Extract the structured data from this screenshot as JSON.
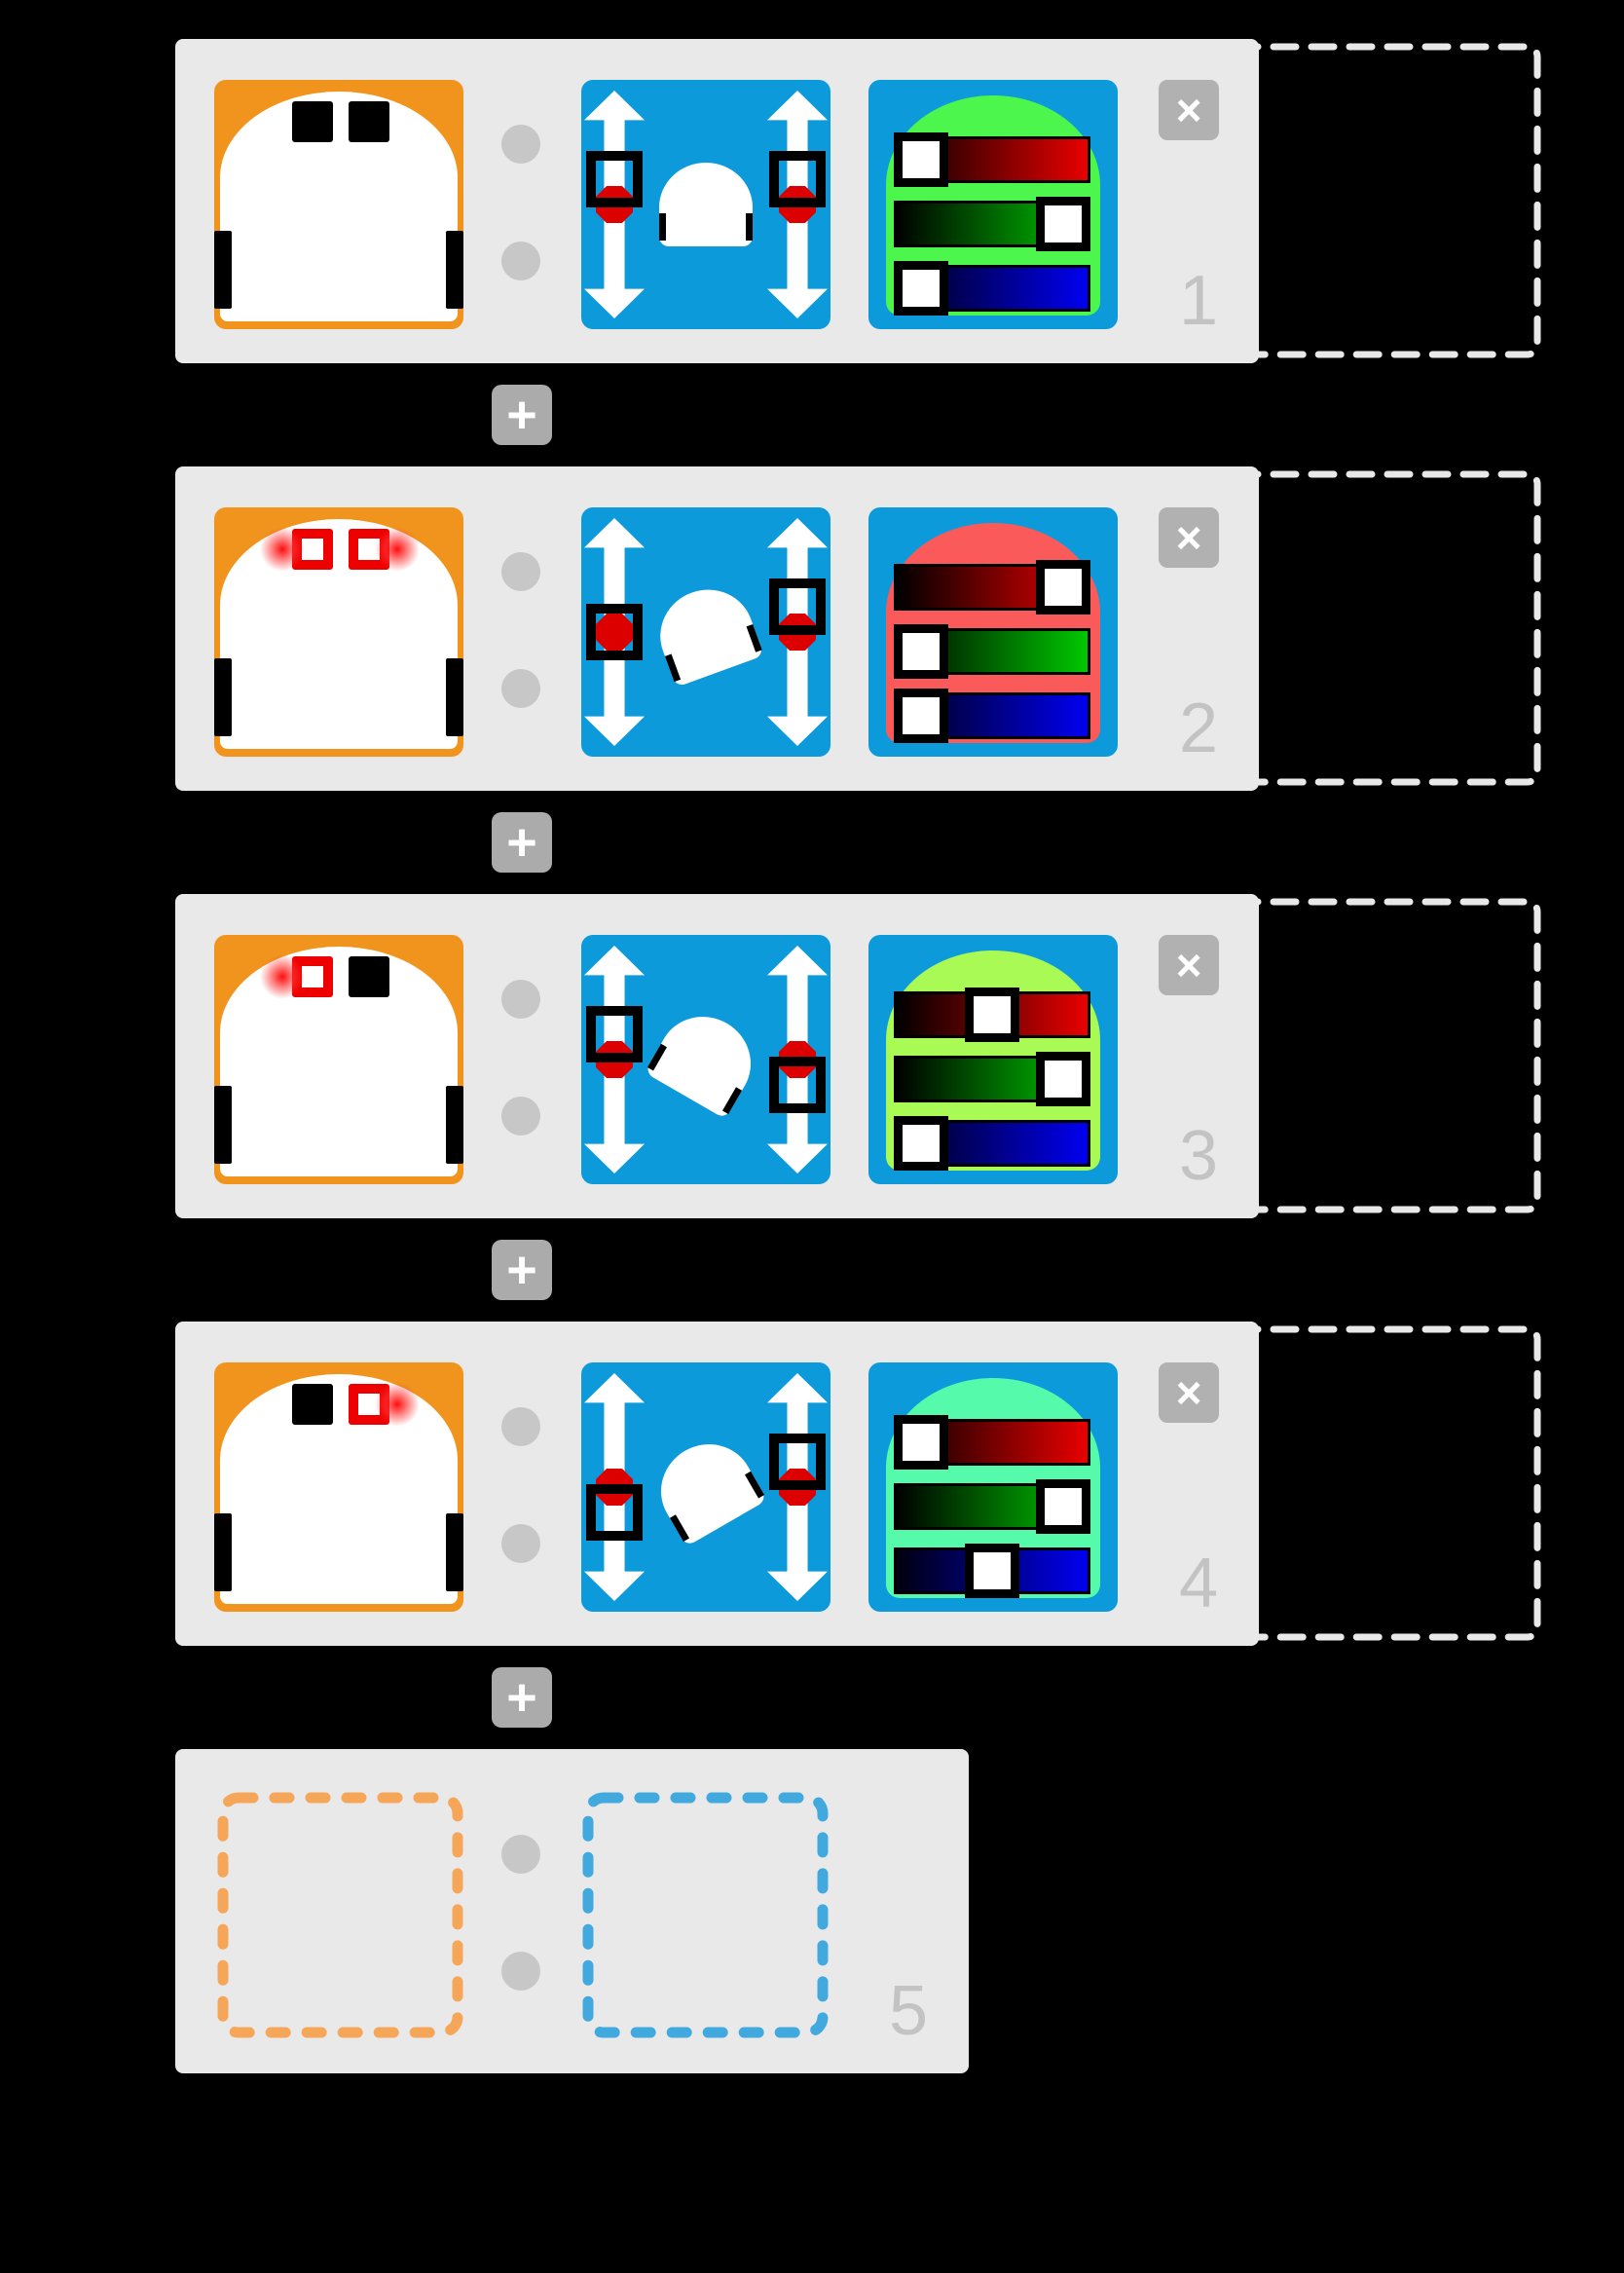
{
  "labels": {
    "add": "+",
    "close": "×"
  },
  "colors": {
    "background": "#000000",
    "card": "#E9E9E9",
    "block_blue": "#0D9ADB",
    "block_orange": "#F0941E",
    "sensor_red": "#EE0000",
    "marker_red": "#DD0000",
    "link_dot": "#C7C7C7",
    "add_button": "#ABABAB",
    "close_button": "#B1B1B1",
    "row_number": "#C3C3C3",
    "drop_dash": "#E8E8E8",
    "placeholder_event_dash": "#F6A659",
    "placeholder_action_dash": "#41A9DE",
    "bar_red_end": "#E80000",
    "bar_green_end": "#00C800",
    "bar_blue_end": "#0000F0"
  },
  "rows": [
    {
      "number": "1",
      "type": "pair",
      "event": {
        "left": "black",
        "right": "black"
      },
      "motor": {
        "left": 0.45,
        "right": 0.45,
        "rotation": 0
      },
      "led": {
        "arch": "#4DF64D",
        "r": 0,
        "g": 1,
        "b": 0
      },
      "drop_target": true
    },
    {
      "number": "2",
      "type": "pair",
      "event": {
        "left": "red",
        "right": "red"
      },
      "motor": {
        "left": 0,
        "right": 0.45,
        "rotation": -20
      },
      "led": {
        "arch": "#FA5A5A",
        "r": 1,
        "g": 0,
        "b": 0
      },
      "drop_target": true
    },
    {
      "number": "3",
      "type": "pair",
      "event": {
        "left": "red",
        "right": "black"
      },
      "motor": {
        "left": 0.45,
        "right": -0.45,
        "rotation": 30
      },
      "led": {
        "arch": "#AAFA55",
        "r": 0.5,
        "g": 1,
        "b": 0
      },
      "drop_target": true
    },
    {
      "number": "4",
      "type": "pair",
      "event": {
        "left": "black",
        "right": "red"
      },
      "motor": {
        "left": -0.45,
        "right": 0.45,
        "rotation": -30
      },
      "led": {
        "arch": "#55FAAA",
        "r": 0,
        "g": 1,
        "b": 0.5
      },
      "drop_target": true
    },
    {
      "number": "5",
      "type": "placeholder"
    }
  ]
}
